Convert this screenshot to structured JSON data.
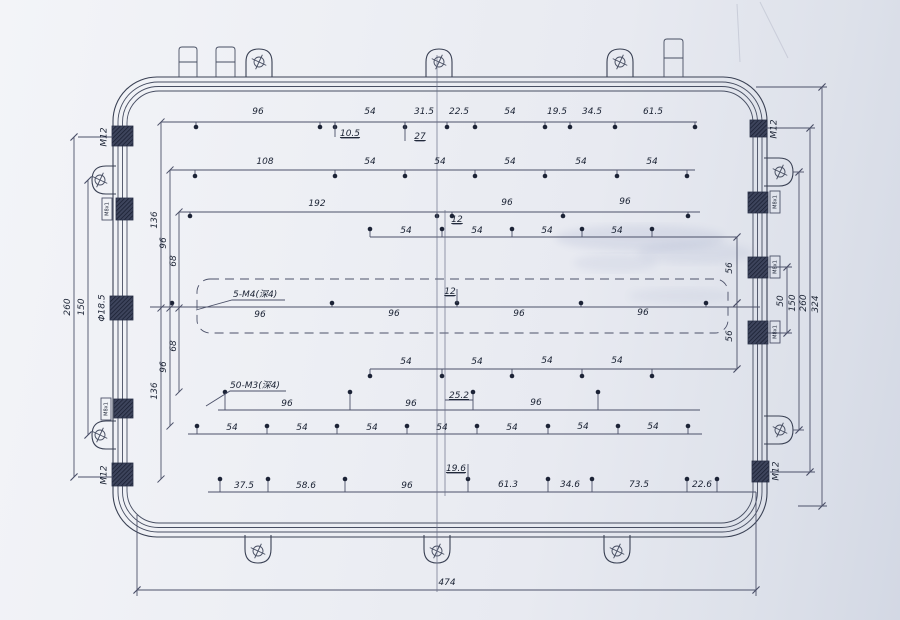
{
  "drawing": {
    "colors": {
      "outline": "#3a4154",
      "dim_line": "#4c5169",
      "text": "#1b2334",
      "paper": "#edeff4",
      "hatch": "#2a3148"
    },
    "outline_rects": [
      {
        "x": 113,
        "y": 77,
        "w": 654,
        "h": 460,
        "r": 44
      },
      {
        "x": 118,
        "y": 82,
        "w": 644,
        "h": 450,
        "r": 40
      },
      {
        "x": 122.5,
        "y": 86.5,
        "w": 635,
        "h": 441,
        "r": 36
      },
      {
        "x": 127,
        "y": 91,
        "w": 626,
        "h": 432,
        "r": 32
      }
    ],
    "dashed_rect": {
      "x": 197,
      "y": 279,
      "w": 531,
      "h": 54,
      "r": 13
    },
    "tabs": [
      {
        "x": 179,
        "y": 47,
        "w": 18,
        "h": 30,
        "split": 62
      },
      {
        "x": 216,
        "y": 47,
        "w": 19,
        "h": 30,
        "split": 62
      },
      {
        "x": 664,
        "y": 39,
        "w": 19,
        "h": 38,
        "split": 58
      }
    ],
    "lugs": [
      {
        "side": "top",
        "c": 259
      },
      {
        "side": "top",
        "c": 439
      },
      {
        "side": "top",
        "c": 620
      },
      {
        "side": "bottom",
        "c": 258
      },
      {
        "side": "bottom",
        "c": 437
      },
      {
        "side": "bottom",
        "c": 617
      },
      {
        "side": "left",
        "c": 180
      },
      {
        "side": "left",
        "c": 435
      },
      {
        "side": "right",
        "c": 172
      },
      {
        "side": "right",
        "c": 430
      }
    ],
    "glands": [
      {
        "x": 112,
        "y": 126,
        "w": 21,
        "h": 20,
        "label": "M12",
        "lx": 104,
        "ly": 137,
        "size": "sub"
      },
      {
        "x": 116,
        "y": 198,
        "w": 17,
        "h": 22,
        "label": "M8x1",
        "lx": 107,
        "ly": 209,
        "size": "tiny",
        "box": true
      },
      {
        "x": 110,
        "y": 296,
        "w": 23,
        "h": 24,
        "label": "Φ18.5",
        "lx": 102,
        "ly": 308,
        "size": "sub"
      },
      {
        "x": 114,
        "y": 399,
        "w": 19,
        "h": 19,
        "label": "M8x1",
        "lx": 106,
        "ly": 409,
        "size": "tiny",
        "box": true
      },
      {
        "x": 112,
        "y": 463,
        "w": 21,
        "h": 23,
        "label": "M12",
        "lx": 104,
        "ly": 475,
        "size": "sub"
      },
      {
        "x": 750,
        "y": 120,
        "w": 17,
        "h": 17,
        "label": "M12",
        "lx": 774,
        "ly": 129,
        "size": "sub"
      },
      {
        "x": 748,
        "y": 192,
        "w": 20,
        "h": 21,
        "label": "M8x1",
        "lx": 775,
        "ly": 202,
        "size": "tiny",
        "box": true
      },
      {
        "x": 748,
        "y": 257,
        "w": 20,
        "h": 21,
        "label": "M8x1",
        "lx": 775,
        "ly": 267,
        "size": "tiny",
        "box": true
      },
      {
        "x": 748,
        "y": 321,
        "w": 20,
        "h": 23,
        "label": "M8x1",
        "lx": 775,
        "ly": 332,
        "size": "tiny",
        "box": true
      },
      {
        "x": 752,
        "y": 461,
        "w": 17,
        "h": 21,
        "label": "M12",
        "lx": 776,
        "ly": 471,
        "size": "sub"
      }
    ],
    "dim_rows": [
      {
        "y": 122,
        "x1": 161,
        "x2": 697,
        "dot_y": 127,
        "dots": [
          196,
          320,
          335,
          405,
          447,
          475,
          545,
          570,
          615,
          695
        ],
        "labels": [
          {
            "t": "96",
            "x": 258,
            "y": 114
          },
          {
            "t": "54",
            "x": 370,
            "y": 114
          },
          {
            "t": "31.5",
            "x": 424,
            "y": 114
          },
          {
            "t": "22.5",
            "x": 459,
            "y": 114
          },
          {
            "t": "54",
            "x": 510,
            "y": 114
          },
          {
            "t": "19.5",
            "x": 557,
            "y": 114
          },
          {
            "t": "34.5",
            "x": 592,
            "y": 114
          },
          {
            "t": "61.5",
            "x": 653,
            "y": 114
          },
          {
            "t": "10.5",
            "x": 350,
            "y": 136,
            "u": true
          },
          {
            "t": "27",
            "x": 420,
            "y": 139,
            "u": true
          }
        ]
      },
      {
        "y": 170,
        "x1": 170,
        "x2": 695,
        "dot_y": 176,
        "dots": [
          195,
          335,
          405,
          475,
          545,
          617,
          687
        ],
        "labels": [
          {
            "t": "108",
            "x": 265,
            "y": 164
          },
          {
            "t": "54",
            "x": 370,
            "y": 164
          },
          {
            "t": "54",
            "x": 440,
            "y": 164
          },
          {
            "t": "54",
            "x": 510,
            "y": 164
          },
          {
            "t": "54",
            "x": 581,
            "y": 164
          },
          {
            "t": "54",
            "x": 652,
            "y": 164
          }
        ]
      },
      {
        "y": 212,
        "x1": 179,
        "x2": 700,
        "dot_y": 216,
        "dots": [
          190,
          437,
          452,
          563,
          688
        ],
        "labels": [
          {
            "t": "192",
            "x": 317,
            "y": 206
          },
          {
            "t": "96",
            "x": 507,
            "y": 205
          },
          {
            "t": "96",
            "x": 625,
            "y": 204
          },
          {
            "t": "12",
            "x": 457,
            "y": 222,
            "u": true
          }
        ]
      },
      {
        "y": 237,
        "x1": 370,
        "x2": 737,
        "dot_y": 229,
        "dots": [
          370,
          442,
          512,
          582,
          652
        ],
        "labels": [
          {
            "t": "54",
            "x": 406,
            "y": 233
          },
          {
            "t": "54",
            "x": 477,
            "y": 233
          },
          {
            "t": "54",
            "x": 547,
            "y": 233
          },
          {
            "t": "54",
            "x": 617,
            "y": 233
          }
        ]
      },
      {
        "y": 307,
        "x1": 150,
        "x2": 760,
        "dot_y": 303,
        "dots": [
          172,
          332,
          457,
          581,
          706
        ],
        "labels": [
          {
            "t": "96",
            "x": 260,
            "y": 317
          },
          {
            "t": "96",
            "x": 394,
            "y": 316
          },
          {
            "t": "96",
            "x": 519,
            "y": 316
          },
          {
            "t": "96",
            "x": 643,
            "y": 315
          },
          {
            "t": "12",
            "x": 450,
            "y": 294,
            "u": true
          }
        ]
      },
      {
        "y": 369,
        "x1": 370,
        "x2": 737,
        "dot_y": 376,
        "dots": [
          370,
          442,
          512,
          582,
          652
        ],
        "labels": [
          {
            "t": "54",
            "x": 406,
            "y": 364
          },
          {
            "t": "54",
            "x": 477,
            "y": 364
          },
          {
            "t": "54",
            "x": 547,
            "y": 363
          },
          {
            "t": "54",
            "x": 617,
            "y": 363
          }
        ]
      },
      {
        "y": 410,
        "x1": 218,
        "x2": 700,
        "dot_y": 392,
        "dots": [
          225,
          350,
          473,
          598
        ],
        "labels": [
          {
            "t": "96",
            "x": 287,
            "y": 406
          },
          {
            "t": "96",
            "x": 411,
            "y": 406
          },
          {
            "t": "96",
            "x": 536,
            "y": 405
          },
          {
            "t": "25.2",
            "x": 459,
            "y": 398,
            "u": true
          }
        ]
      },
      {
        "y": 434,
        "x1": 188,
        "x2": 702,
        "dot_y": 426,
        "dots": [
          197,
          267,
          337,
          407,
          477,
          548,
          618,
          688
        ],
        "labels": [
          {
            "t": "54",
            "x": 232,
            "y": 430
          },
          {
            "t": "54",
            "x": 302,
            "y": 430
          },
          {
            "t": "54",
            "x": 372,
            "y": 430
          },
          {
            "t": "54",
            "x": 442,
            "y": 430
          },
          {
            "t": "54",
            "x": 512,
            "y": 430
          },
          {
            "t": "54",
            "x": 583,
            "y": 429
          },
          {
            "t": "54",
            "x": 653,
            "y": 429
          }
        ]
      },
      {
        "y": 492,
        "x1": 208,
        "x2": 756,
        "dot_y": 479,
        "dots": [
          220,
          268,
          345,
          468,
          548,
          592,
          687,
          717
        ],
        "labels": [
          {
            "t": "37.5",
            "x": 244,
            "y": 488
          },
          {
            "t": "58.6",
            "x": 306,
            "y": 488
          },
          {
            "t": "96",
            "x": 407,
            "y": 488
          },
          {
            "t": "61.3",
            "x": 508,
            "y": 487
          },
          {
            "t": "34.6",
            "x": 570,
            "y": 487
          },
          {
            "t": "73.5",
            "x": 639,
            "y": 487
          },
          {
            "t": "22.6",
            "x": 702,
            "y": 487
          },
          {
            "t": "19.6",
            "x": 456,
            "y": 471,
            "u": true
          }
        ]
      }
    ],
    "hdims": [
      {
        "t": "474",
        "x1": 137,
        "x2": 756,
        "y": 590,
        "lx": 447,
        "ly": 585
      }
    ],
    "vdims": [
      {
        "t": "136",
        "x": 161,
        "y1": 122,
        "y2": 479,
        "lx": 157,
        "ly": 220
      },
      {
        "t": "96",
        "x": 170,
        "y1": 170,
        "y2": 426,
        "lx": 166,
        "ly": 243
      },
      {
        "t": "68",
        "x": 179,
        "y1": 212,
        "y2": 392,
        "lx": 176,
        "ly": 261
      },
      {
        "t": "68",
        "x": 179,
        "y1": 212,
        "y2": 392,
        "lx": 176,
        "ly": 346
      },
      {
        "t": "96",
        "x": 170,
        "y1": 170,
        "y2": 426,
        "lx": 166,
        "ly": 367
      },
      {
        "t": "136",
        "x": 161,
        "y1": 122,
        "y2": 479,
        "lx": 157,
        "ly": 391
      },
      {
        "t": "150",
        "x": 88,
        "y1": 180,
        "y2": 435,
        "lx": 84,
        "ly": 307
      },
      {
        "t": "260",
        "x": 74,
        "y1": 137,
        "y2": 477,
        "lx": 70,
        "ly": 307
      },
      {
        "t": "56",
        "x": 737,
        "y1": 237,
        "y2": 303,
        "lx": 732,
        "ly": 268
      },
      {
        "t": "56",
        "x": 737,
        "y1": 303,
        "y2": 369,
        "lx": 732,
        "ly": 336
      },
      {
        "t": "50",
        "x": 787,
        "y1": 267,
        "y2": 333,
        "lx": 783,
        "ly": 301
      },
      {
        "t": "150",
        "x": 799,
        "y1": 172,
        "y2": 430,
        "lx": 795,
        "ly": 303
      },
      {
        "t": "260",
        "x": 810,
        "y1": 128,
        "y2": 472,
        "lx": 806,
        "ly": 303
      },
      {
        "t": "324",
        "x": 822,
        "y1": 87,
        "y2": 506,
        "lx": 818,
        "ly": 304
      }
    ],
    "callouts": [
      {
        "t": "5-M4(深4)",
        "x": 233,
        "y": 297,
        "leader": [
          [
            285,
            300
          ],
          [
            232,
            300
          ],
          [
            196,
            310
          ]
        ]
      },
      {
        "t": "50-M3(深4)",
        "x": 230,
        "y": 388,
        "leader": [
          [
            286,
            391
          ],
          [
            230,
            391
          ],
          [
            206,
            406
          ]
        ]
      }
    ],
    "vlines": [
      {
        "x": 437,
        "y1": 55,
        "y2": 592,
        "cls": "cl"
      },
      {
        "x": 445,
        "y1": 210,
        "y2": 496,
        "cls": "cl"
      },
      {
        "x": 335,
        "y1": 122,
        "y2": 137,
        "cls": "dl"
      },
      {
        "x": 405,
        "y1": 122,
        "y2": 141,
        "cls": "dl"
      },
      {
        "x": 457,
        "y1": 289,
        "y2": 303,
        "cls": "dl"
      },
      {
        "x": 468,
        "y1": 464,
        "y2": 479,
        "cls": "dl"
      },
      {
        "x": 137,
        "y1": 515,
        "y2": 596,
        "cls": "dl"
      },
      {
        "x": 756,
        "y1": 492,
        "y2": 596,
        "cls": "dl"
      }
    ],
    "hlines": [
      {
        "y": 128,
        "x1": 766,
        "x2": 815,
        "cls": "dl"
      },
      {
        "y": 87,
        "x1": 756,
        "x2": 827,
        "cls": "dl"
      },
      {
        "y": 267,
        "x1": 768,
        "x2": 792,
        "cls": "dl"
      },
      {
        "y": 333,
        "x1": 768,
        "x2": 792,
        "cls": "dl"
      },
      {
        "y": 472,
        "x1": 770,
        "x2": 815,
        "cls": "dl"
      },
      {
        "y": 172,
        "x1": 793,
        "x2": 804,
        "cls": "dl"
      },
      {
        "y": 430,
        "x1": 793,
        "x2": 804,
        "cls": "dl"
      },
      {
        "y": 506,
        "x1": 798,
        "x2": 827,
        "cls": "dl"
      },
      {
        "y": 137,
        "x1": 78,
        "x2": 113,
        "cls": "dl"
      },
      {
        "y": 477,
        "x1": 78,
        "x2": 113,
        "cls": "dl"
      },
      {
        "y": 400,
        "x1": 445,
        "x2": 473,
        "cls": "dl"
      }
    ],
    "ticks": [
      [
        161,
        308
      ],
      [
        170,
        308
      ],
      [
        179,
        308
      ],
      [
        737,
        237
      ],
      [
        737,
        303
      ],
      [
        737,
        369
      ],
      [
        787,
        267
      ],
      [
        787,
        333
      ],
      [
        799,
        172
      ],
      [
        799,
        430
      ],
      [
        810,
        128
      ],
      [
        810,
        472
      ],
      [
        822,
        87
      ],
      [
        822,
        506
      ],
      [
        74,
        137
      ],
      [
        74,
        477
      ],
      [
        88,
        180
      ],
      [
        88,
        435
      ],
      [
        137,
        590
      ],
      [
        756,
        590
      ]
    ],
    "smudges": [
      {
        "cx": 640,
        "cy": 238,
        "rx": 85,
        "ry": 13,
        "o": 0.1
      },
      {
        "cx": 695,
        "cy": 253,
        "rx": 58,
        "ry": 11,
        "o": 0.08
      },
      {
        "cx": 615,
        "cy": 263,
        "rx": 42,
        "ry": 9,
        "o": 0.07
      },
      {
        "cx": 680,
        "cy": 296,
        "rx": 52,
        "ry": 8,
        "o": 0.06
      }
    ],
    "creases": [
      {
        "x1": 737,
        "y1": 4,
        "x2": 740,
        "y2": 62
      },
      {
        "x1": 760,
        "y1": 2,
        "x2": 788,
        "y2": 58
      }
    ]
  }
}
